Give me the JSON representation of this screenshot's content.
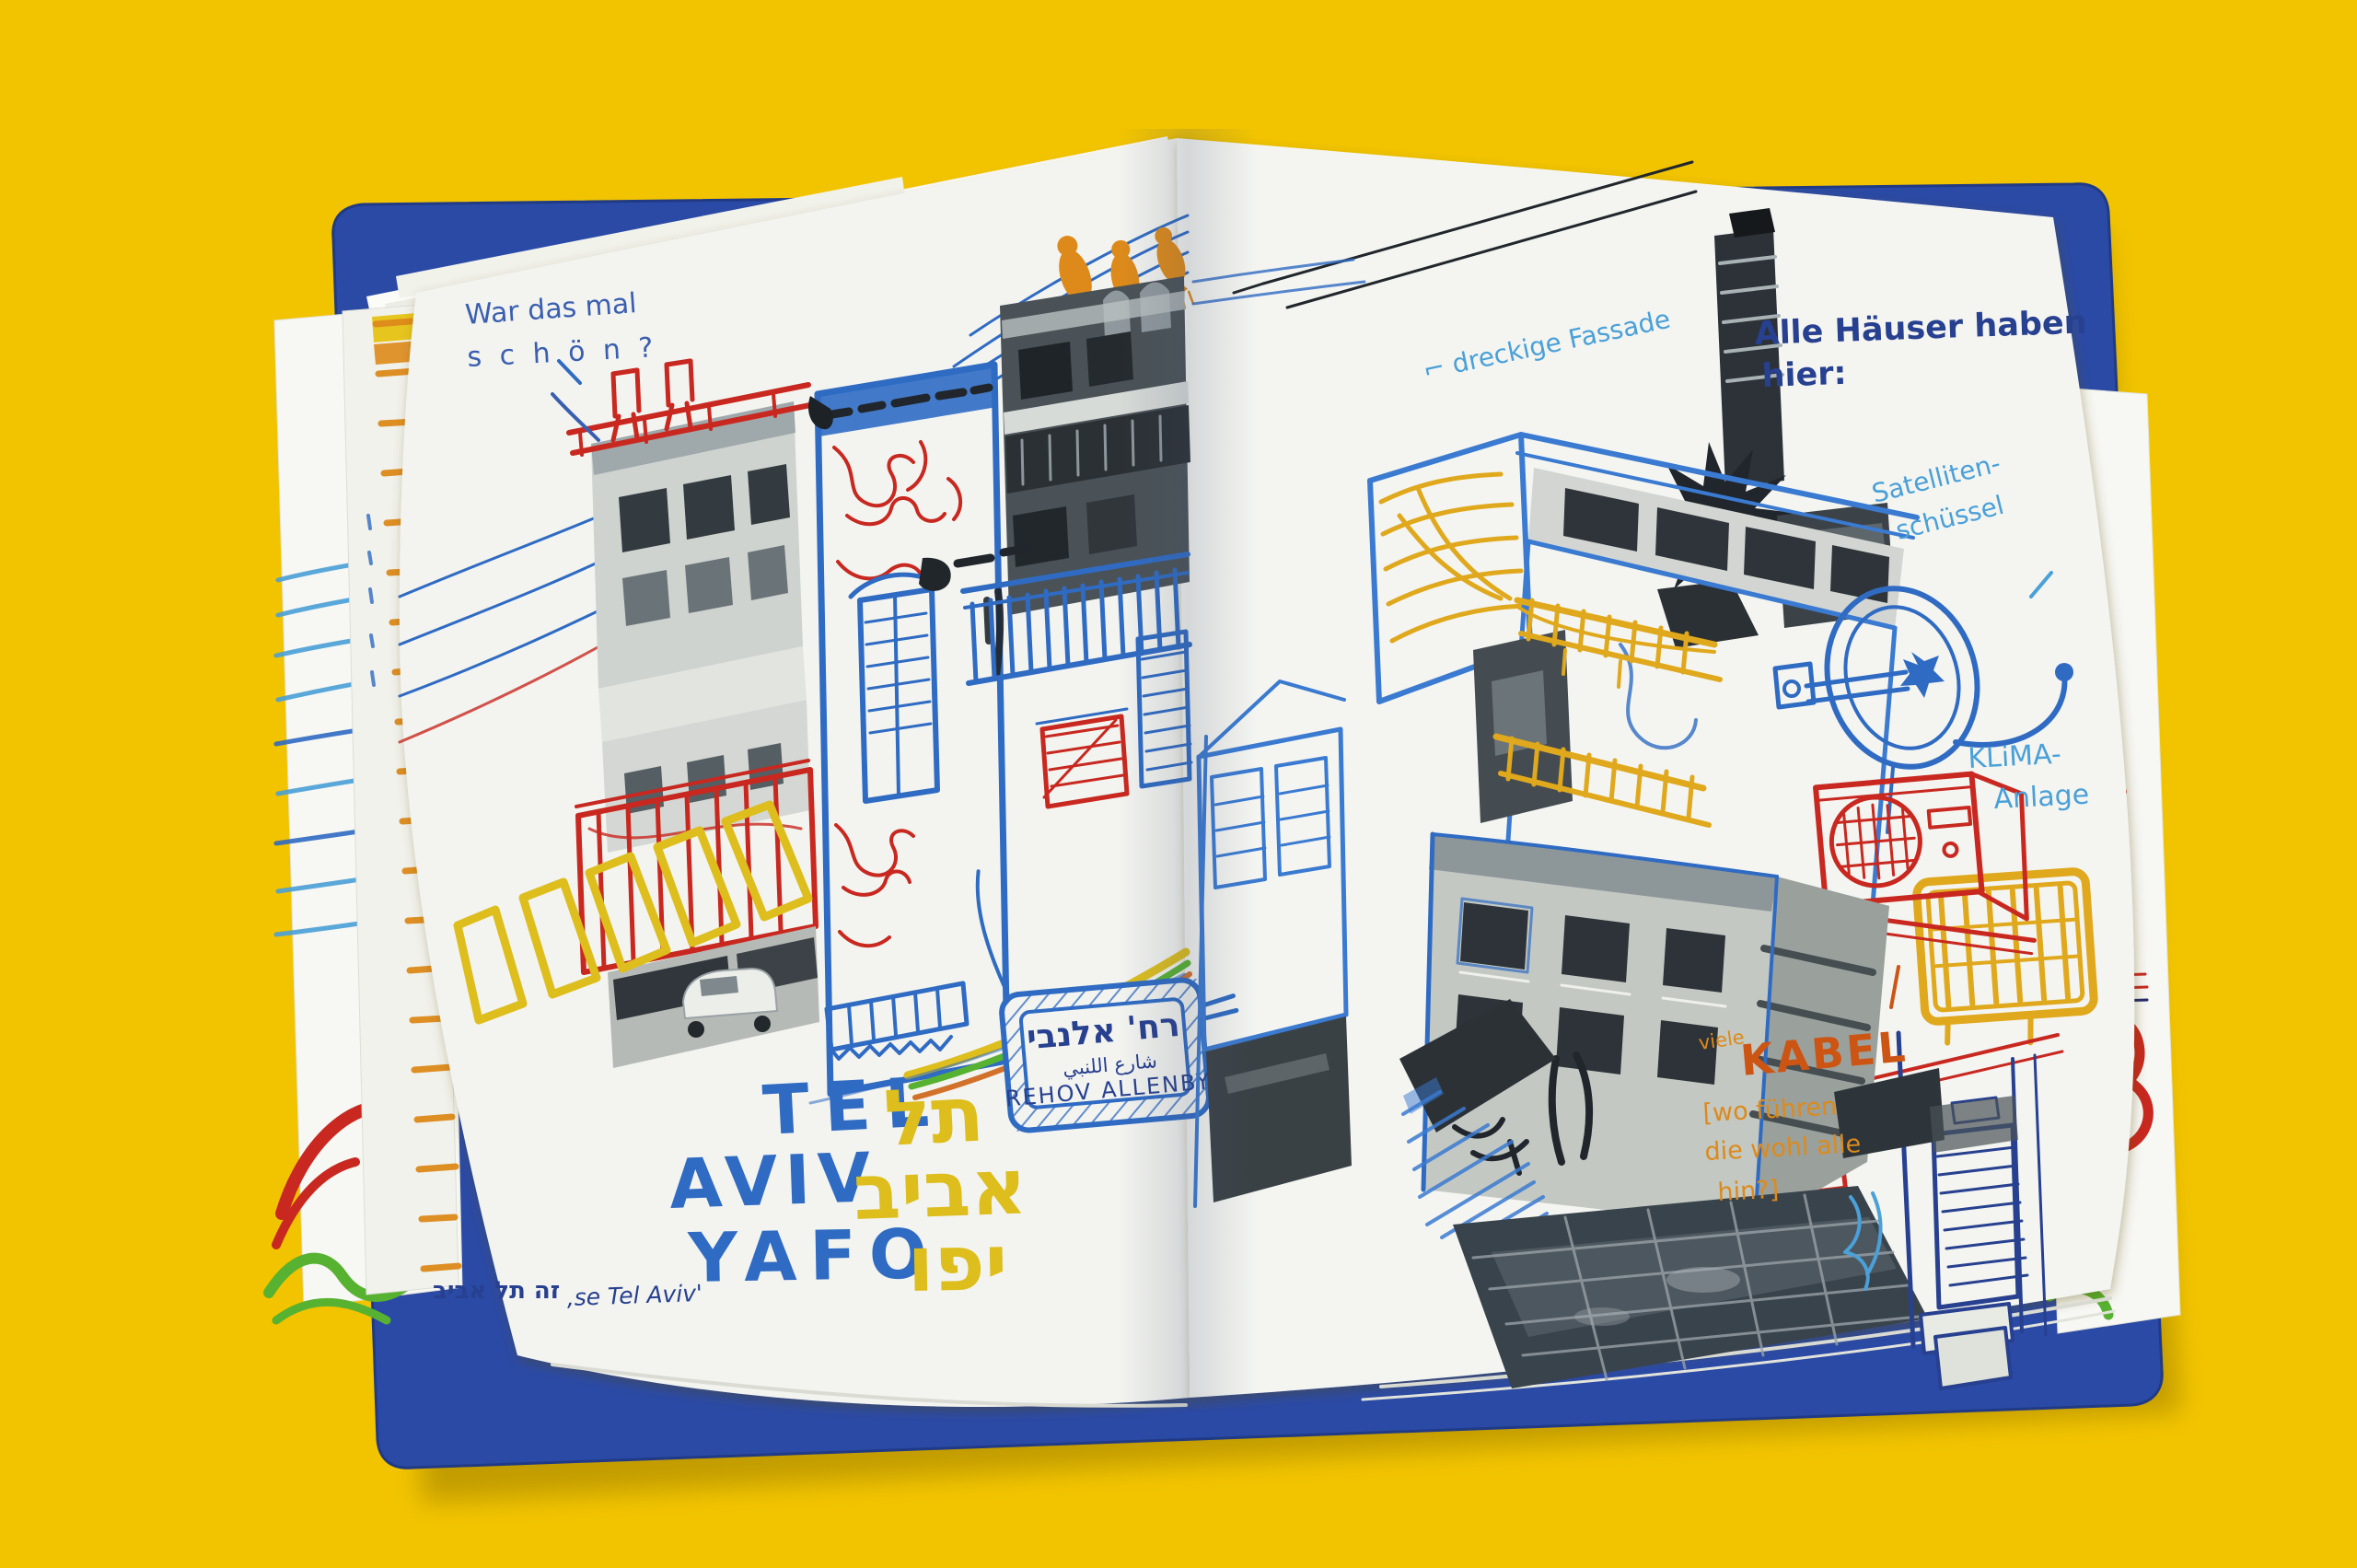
{
  "palette": {
    "bg-yellow": "#f2c400",
    "cover-blue": "#2b4aa5",
    "page-white": "#f3f4f0",
    "ink-blue": "#2f6bc3",
    "ink-blue-light": "#3a7ad1",
    "ink-dark": "#27408f",
    "ink-sky": "#4aa0d8",
    "hand-blue": "#3a5fb0",
    "ink-red": "#c8281f",
    "ink-orange": "#dd8a1a",
    "ink-orange-deep": "#cc5514",
    "ink-yellow": "#ddbe1d",
    "ink-yellow-deep": "#e0a81c",
    "ink-green": "#58b231",
    "photo-dark": "#20262b"
  },
  "left_page": {
    "note": {
      "line1": "War das mal",
      "line2": "s c h ö n ?"
    },
    "title": {
      "latin1": "TEL",
      "hebrew1": "תל",
      "latin2": "AVIV",
      "hebrew2": "אביב",
      "latin3": "YAFO",
      "hebrew3": "יפו"
    },
    "street_sign": {
      "hebrew": "רח' אלנבי",
      "arabic": "شارع اللنبي",
      "latin": "REHOV ALLENBY"
    },
    "caption": {
      "hebrew": "זה תל אביב",
      "latin": "‚se Tel Aviv'"
    }
  },
  "right_page": {
    "heading": {
      "line1": "Alle Häuser haben",
      "line2": "hier:"
    },
    "labels": {
      "fassade": "⌐ dreckige Fassade",
      "satellit_line1": "Satelliten-",
      "satellit_line2": "schüssel",
      "klima_line1": "KLiMA-",
      "klima_line2": "Anlage",
      "kabel_small": "viele",
      "kabel_big": "KABEL",
      "kabel_note1": "[wo führen",
      "kabel_note2": "die wohl alle",
      "kabel_note3": "hin?]"
    }
  }
}
